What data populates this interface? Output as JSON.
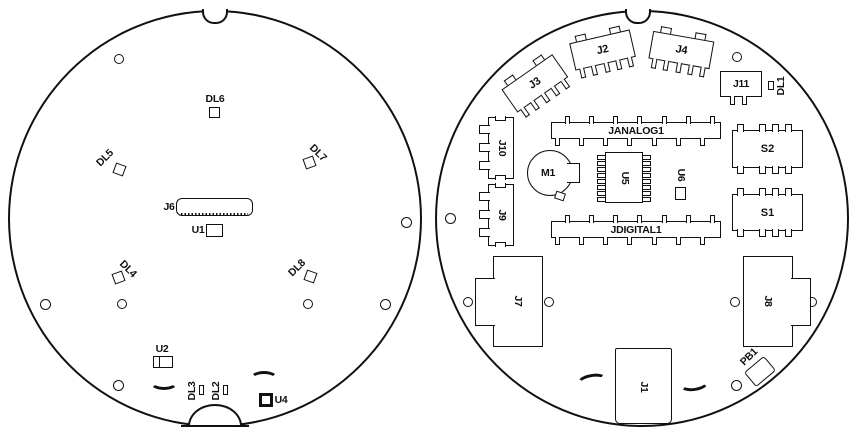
{
  "left_board": {
    "dl6": "DL6",
    "dl5": "DL5",
    "dl7": "DL7",
    "j6": "J6",
    "u1": "U1",
    "dl4": "DL4",
    "dl8": "DL8",
    "u2": "U2",
    "dl3": "DL3",
    "dl2": "DL2",
    "u4": "U4"
  },
  "right_board": {
    "j3": "J3",
    "j2": "J2",
    "j4": "J4",
    "j11": "J11",
    "dl1": "DL1",
    "j10": "J10",
    "j9": "J9",
    "janalog": "JANALOG1",
    "jdigital": "JDIGITAL1",
    "m1": "M1",
    "u5": "U5",
    "u6": "U6",
    "s2": "S2",
    "s1": "S1",
    "j7": "J7",
    "j8": "J8",
    "j1": "J1",
    "pb1": "PB1"
  }
}
